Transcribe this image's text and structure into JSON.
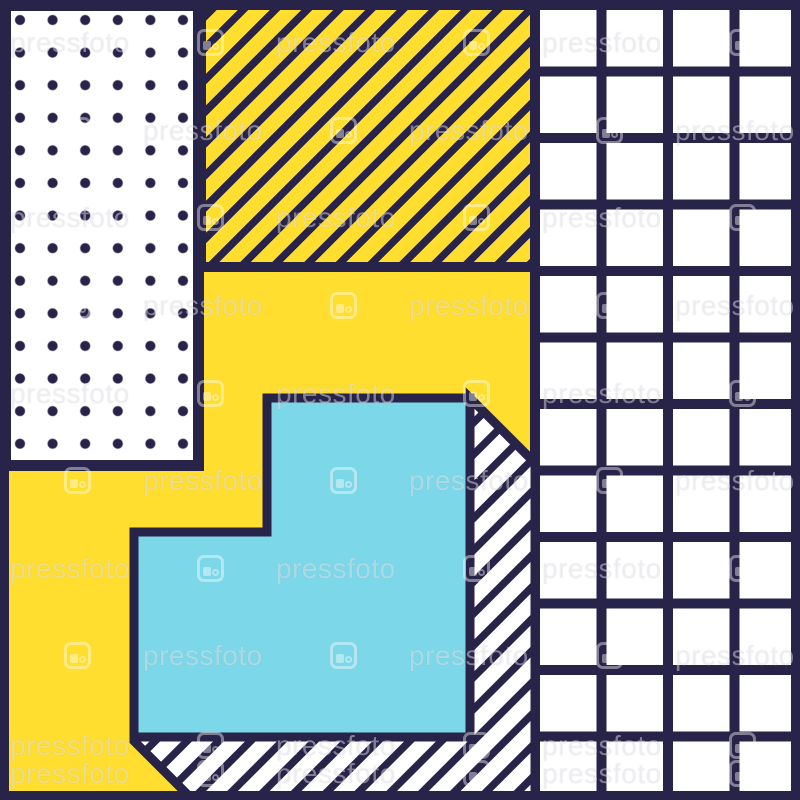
{
  "colors": {
    "navy": "#282349",
    "yellow": "#FFDE2F",
    "cyan": "#7CD7E9",
    "white": "#FFFFFF",
    "watermark": "rgba(255,255,255,0.42)"
  },
  "panels": {
    "dotted": {
      "pattern": "polka-dots",
      "fill": "#FFFFFF",
      "accent": "#282349"
    },
    "striped": {
      "pattern": "diagonal-stripes",
      "fill": "#FFDE2F",
      "accent": "#282349"
    },
    "grid": {
      "pattern": "square-grid",
      "fill": "#FFFFFF",
      "accent": "#282349"
    },
    "background": {
      "pattern": "solid",
      "fill": "#FFDE2F"
    },
    "step_shape": {
      "pattern": "solid",
      "fill": "#7CD7E9",
      "outline": "#282349"
    },
    "step_shape_shadow": {
      "pattern": "diagonal-stripes",
      "fill": "#FFFFFF",
      "accent": "#282349"
    }
  },
  "watermark": {
    "text": "pressfoto",
    "logo": "pressfoto-camera-logo",
    "layouts": {
      "A": {
        "texts": [
          10,
          276,
          542
        ],
        "logos": [
          197,
          463,
          729
        ]
      },
      "B": {
        "texts": [
          143,
          409,
          675
        ],
        "logos": [
          64,
          330,
          596
        ]
      }
    },
    "rows": [
      {
        "type": "A",
        "y": 32
      },
      {
        "type": "B",
        "y": 120
      },
      {
        "type": "A",
        "y": 207
      },
      {
        "type": "B",
        "y": 295
      },
      {
        "type": "A",
        "y": 383
      },
      {
        "type": "B",
        "y": 470
      },
      {
        "type": "A",
        "y": 558
      },
      {
        "type": "B",
        "y": 645
      },
      {
        "type": "A",
        "y": 735
      },
      {
        "type": "A",
        "y": 763
      }
    ]
  }
}
